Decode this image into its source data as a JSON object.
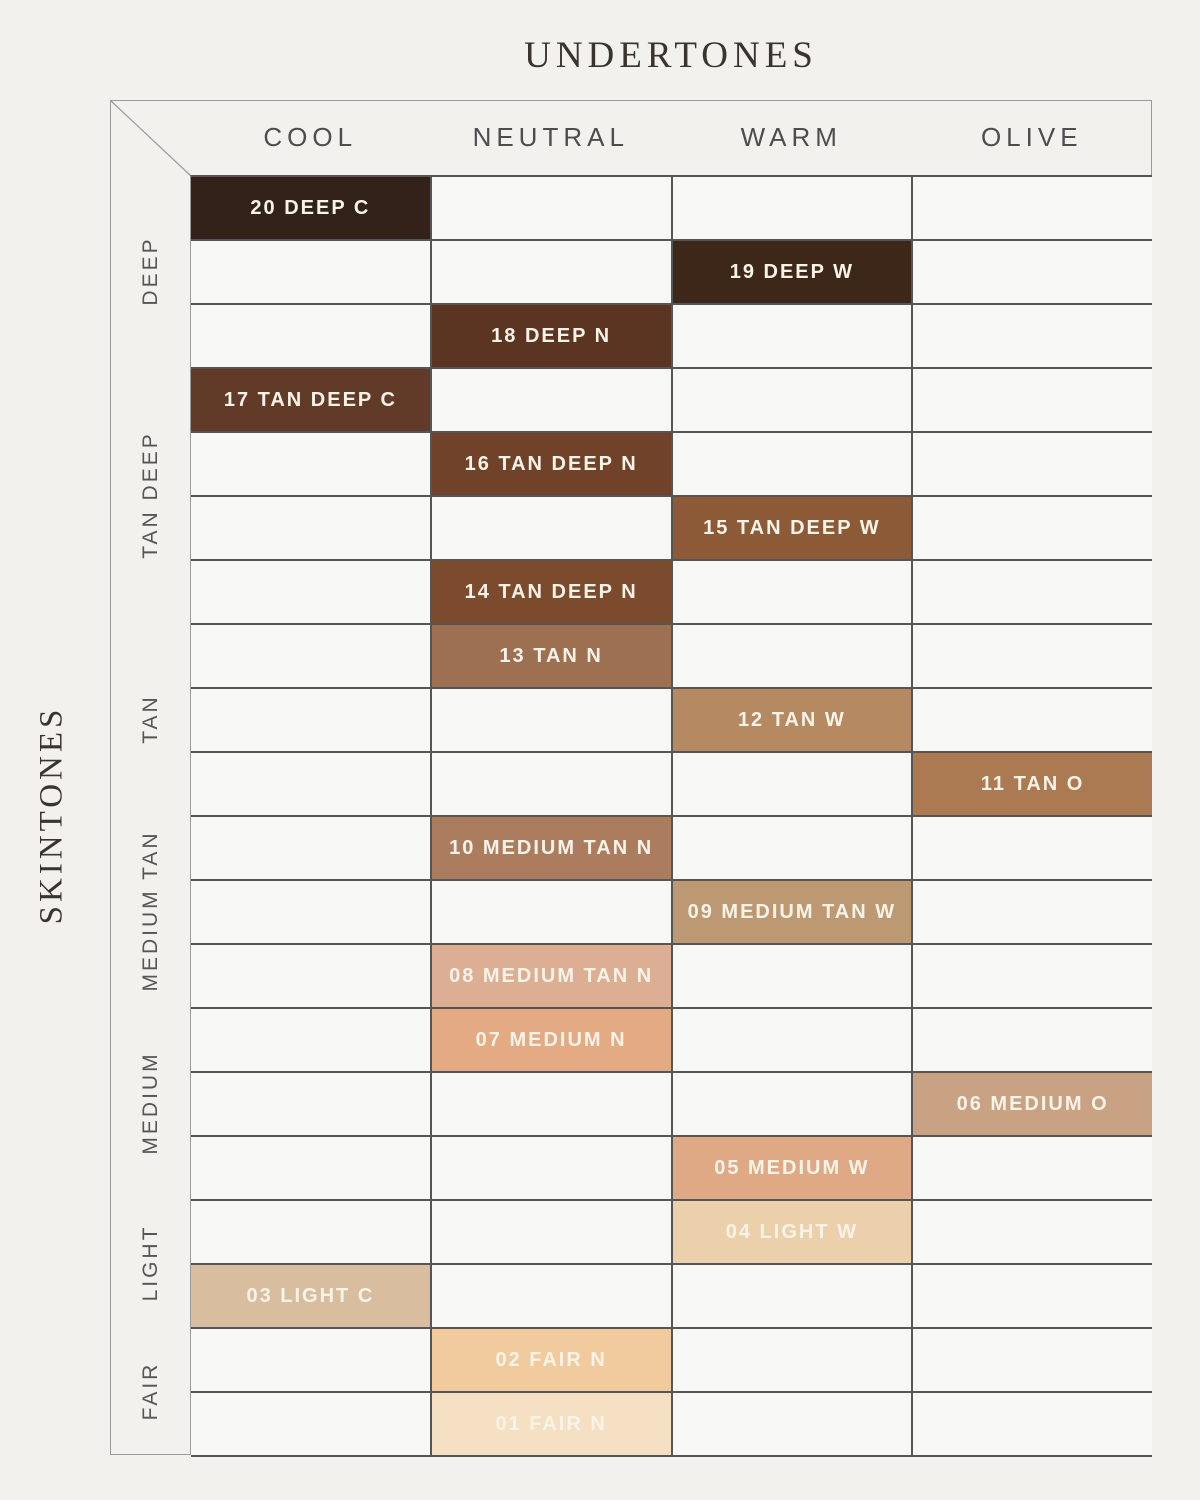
{
  "chart_data": {
    "type": "heatmap",
    "x_axis_label": "UNDERTONES",
    "y_axis_label": "SKINTONES",
    "x_categories": [
      "COOL",
      "NEUTRAL",
      "WARM",
      "OLIVE"
    ],
    "y_groups": [
      {
        "label": "DEEP",
        "row_count": 3
      },
      {
        "label": "TAN DEEP",
        "row_count": 4
      },
      {
        "label": "TAN",
        "row_count": 3
      },
      {
        "label": "MEDIUM TAN",
        "row_count": 3
      },
      {
        "label": "MEDIUM",
        "row_count": 3
      },
      {
        "label": "LIGHT",
        "row_count": 2
      },
      {
        "label": "FAIR",
        "row_count": 2
      }
    ],
    "rows": 20,
    "cells": [
      {
        "row": 1,
        "undertone": "COOL",
        "skintone": "DEEP",
        "label": "20 DEEP C",
        "color": "#33221a"
      },
      {
        "row": 2,
        "undertone": "WARM",
        "skintone": "DEEP",
        "label": "19 DEEP W",
        "color": "#3d2718"
      },
      {
        "row": 3,
        "undertone": "NEUTRAL",
        "skintone": "DEEP",
        "label": "18 DEEP N",
        "color": "#5b3422"
      },
      {
        "row": 4,
        "undertone": "COOL",
        "skintone": "TAN DEEP",
        "label": "17 TAN DEEP C",
        "color": "#613a28"
      },
      {
        "row": 5,
        "undertone": "NEUTRAL",
        "skintone": "TAN DEEP",
        "label": "16 TAN DEEP N",
        "color": "#6f4229"
      },
      {
        "row": 6,
        "undertone": "WARM",
        "skintone": "TAN DEEP",
        "label": "15 TAN DEEP W",
        "color": "#8c5a37"
      },
      {
        "row": 7,
        "undertone": "NEUTRAL",
        "skintone": "TAN DEEP",
        "label": "14 TAN DEEP N",
        "color": "#7c4a2d"
      },
      {
        "row": 8,
        "undertone": "NEUTRAL",
        "skintone": "TAN",
        "label": "13 TAN N",
        "color": "#9d7051"
      },
      {
        "row": 9,
        "undertone": "WARM",
        "skintone": "TAN",
        "label": "12 TAN W",
        "color": "#b58a63"
      },
      {
        "row": 10,
        "undertone": "OLIVE",
        "skintone": "TAN",
        "label": "11 TAN O",
        "color": "#ab7a53"
      },
      {
        "row": 11,
        "undertone": "NEUTRAL",
        "skintone": "MEDIUM TAN",
        "label": "10 MEDIUM TAN N",
        "color": "#ab7d5e"
      },
      {
        "row": 12,
        "undertone": "WARM",
        "skintone": "MEDIUM TAN",
        "label": "09 MEDIUM TAN W",
        "color": "#bd9973"
      },
      {
        "row": 13,
        "undertone": "NEUTRAL",
        "skintone": "MEDIUM TAN",
        "label": "08 MEDIUM TAN N",
        "color": "#dcae93"
      },
      {
        "row": 14,
        "undertone": "NEUTRAL",
        "skintone": "MEDIUM",
        "label": "07 MEDIUM N",
        "color": "#e3aa83"
      },
      {
        "row": 15,
        "undertone": "OLIVE",
        "skintone": "MEDIUM",
        "label": "06 MEDIUM O",
        "color": "#c9a183"
      },
      {
        "row": 16,
        "undertone": "WARM",
        "skintone": "MEDIUM",
        "label": "05 MEDIUM W",
        "color": "#e0a985"
      },
      {
        "row": 17,
        "undertone": "WARM",
        "skintone": "LIGHT",
        "label": "04 LIGHT W",
        "color": "#ecd0ab"
      },
      {
        "row": 18,
        "undertone": "COOL",
        "skintone": "LIGHT",
        "label": "03 LIGHT C",
        "color": "#d9bd9f"
      },
      {
        "row": 19,
        "undertone": "NEUTRAL",
        "skintone": "FAIR",
        "label": "02 FAIR N",
        "color": "#f1cb9e"
      },
      {
        "row": 20,
        "undertone": "NEUTRAL",
        "skintone": "FAIR",
        "label": "01 FAIR N",
        "color": "#f5e0c3"
      }
    ],
    "colors": {
      "page_background": "#f2f1ee",
      "cell_background": "#f8f8f6",
      "grid_line": "#555555",
      "frame_line": "#9a9a9a",
      "header_text": "#4d4d4d",
      "group_label_text": "#565656",
      "axis_title_text": "#3a342e",
      "shade_label_text": "#faf4e8"
    }
  }
}
